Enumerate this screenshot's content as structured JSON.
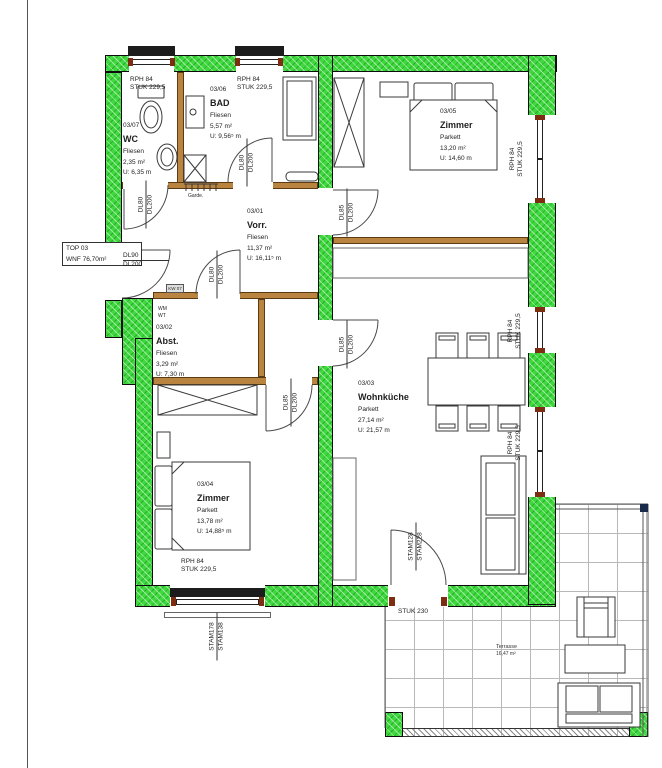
{
  "unit_label": {
    "line1": "TOP 03",
    "line2": "WNF 76,70m²"
  },
  "rooms": [
    {
      "id": "03/07",
      "name": "WC",
      "floor": "Fliesen",
      "area": "2,35 m²",
      "perimeter": "U: 6,35 m"
    },
    {
      "id": "03/06",
      "name": "BAD",
      "floor": "Fliesen",
      "area": "5,57 m²",
      "perimeter": "U: 9,56⁵ m"
    },
    {
      "id": "03/01",
      "name": "Vorr.",
      "floor": "Fliesen",
      "area": "11,37 m²",
      "perimeter": "U: 16,11⁵ m"
    },
    {
      "id": "03/02",
      "name": "Abst.",
      "floor": "Fliesen",
      "area": "3,29 m²",
      "perimeter": "U: 7,30 m"
    },
    {
      "id": "03/05",
      "name": "Zimmer",
      "floor": "Parkett",
      "area": "13,20 m²",
      "perimeter": "U: 14,60 m"
    },
    {
      "id": "03/03",
      "name": "Wohnküche",
      "floor": "Parkett",
      "area": "27,14 m²",
      "perimeter": "U: 21,57 m"
    },
    {
      "id": "03/04",
      "name": "Zimmer",
      "floor": "Parkett",
      "area": "13,78 m²",
      "perimeter": "U: 14,88⁵ m"
    }
  ],
  "terrace": {
    "name": "Terrasse",
    "area": "16,47 m²"
  },
  "window_label": {
    "l1": "RPH 84",
    "l2": "STUK 229,5"
  },
  "door_labels": {
    "entrance": {
      "l1": "DL90",
      "l2": "DL200"
    },
    "dl80": {
      "l1": "DL80",
      "l2": "DL200"
    },
    "dl85": {
      "l1": "DL85",
      "l2": "DL200"
    },
    "terrace_door": {
      "l1": "STAM128",
      "l2": "STAM228"
    },
    "bottom_window": {
      "l1": "STAM178",
      "l2": "STAM138"
    },
    "stuk230": "STUK 230"
  },
  "annotations": {
    "garde": "Garde.",
    "wm": "WM",
    "wt": "WT",
    "kw": "KW 07"
  },
  "colors": {
    "wall_green": "#3fd83f",
    "partition_brown": "#b98440",
    "window_frame_brown": "#7c2d12",
    "outline": "#0d0d0d"
  }
}
